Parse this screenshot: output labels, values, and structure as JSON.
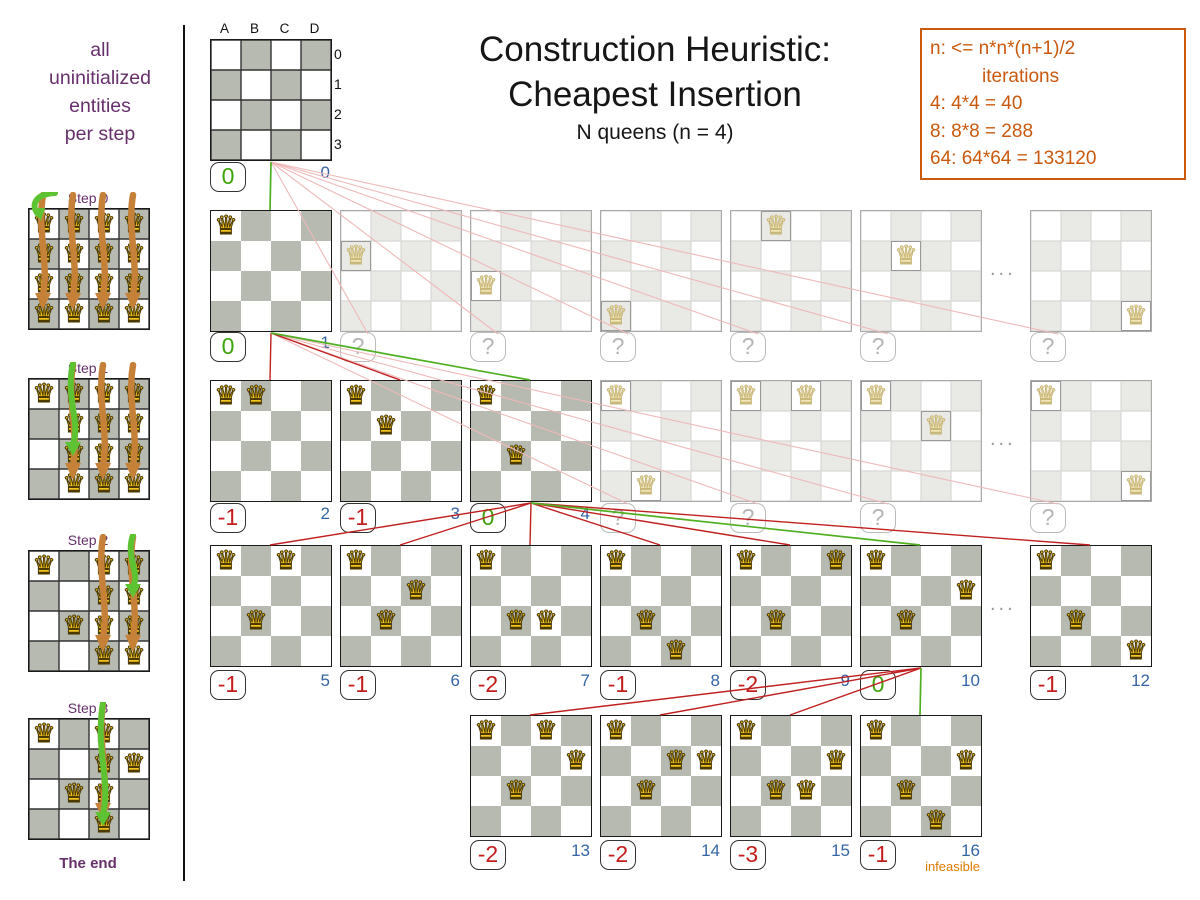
{
  "colors": {
    "purple": "#66306b",
    "orange": "#c9590f",
    "score_green": "#3fa30c",
    "score_red": "#c21e1e",
    "iteration_blue": "#3465a4",
    "line_green": "#4faf21",
    "line_red": "#c02020",
    "line_pruned": "#efb9b9",
    "board_gray": "#b7bab0",
    "queen_gold": "#f2c41d",
    "infeasible_orange": "#e07a00",
    "arrow_orange": "#c58138",
    "arrow_green": "#5ec332"
  },
  "sidebar": {
    "intro_lines": [
      "all",
      "uninitialized",
      "entities",
      "per step"
    ],
    "end_label": "The end",
    "steps": [
      {
        "label": "Step 0",
        "fixed": [],
        "candidate_columns": [
          "A",
          "B",
          "C",
          "D"
        ],
        "chosen": "A0"
      },
      {
        "label": "Step 1",
        "fixed": [
          "A0"
        ],
        "candidate_columns": [
          "B",
          "C",
          "D"
        ],
        "chosen": "B2"
      },
      {
        "label": "Step 2",
        "fixed": [
          "A0",
          "B2"
        ],
        "candidate_columns": [
          "C",
          "D"
        ],
        "chosen": "D1"
      },
      {
        "label": "Step 3",
        "fixed": [
          "A0",
          "B2",
          "D1"
        ],
        "candidate_columns": [
          "C"
        ],
        "chosen": "C3"
      }
    ]
  },
  "header": {
    "title_line1": "Construction Heuristic:",
    "title_line2": "Cheapest Insertion",
    "subtitle": "N queens (n = 4)"
  },
  "info_box": {
    "lines": [
      "n: <= n*n*(n+1)/2",
      "iterations",
      "4: 4*4 = 40",
      "8: 8*8 = 288",
      "64: 64*64 = 133120"
    ]
  },
  "root_labels": {
    "columns": [
      "A",
      "B",
      "C",
      "D"
    ],
    "rows": [
      "0",
      "1",
      "2",
      "3"
    ]
  },
  "tree": {
    "ellipsis": "...",
    "rows": [
      {
        "boards": [
          {
            "slot": 0,
            "queens": [],
            "score": "0",
            "iteration": "0"
          }
        ]
      },
      {
        "parent_slot": 0,
        "ellipsis": true,
        "boards": [
          {
            "slot": 0,
            "queens": [
              "A0"
            ],
            "score": "0",
            "iteration": "1",
            "link": "chosen"
          },
          {
            "slot": 1,
            "queens": [
              "A1"
            ],
            "score": "?",
            "link": "pruned"
          },
          {
            "slot": 2,
            "queens": [
              "A2"
            ],
            "score": "?",
            "link": "pruned"
          },
          {
            "slot": 3,
            "queens": [
              "A3"
            ],
            "score": "?",
            "link": "pruned"
          },
          {
            "slot": 4,
            "queens": [
              "B0"
            ],
            "score": "?",
            "link": "pruned"
          },
          {
            "slot": 5,
            "queens": [
              "B1"
            ],
            "score": "?",
            "link": "pruned"
          },
          {
            "slot": 7,
            "queens": [
              "D3"
            ],
            "score": "?",
            "link": "pruned"
          }
        ]
      },
      {
        "parent_slot": 0,
        "ellipsis": true,
        "boards": [
          {
            "slot": 0,
            "queens": [
              "A0",
              "B0"
            ],
            "score": "-1",
            "iteration": "2",
            "link": "evaluated"
          },
          {
            "slot": 1,
            "queens": [
              "A0",
              "B1"
            ],
            "score": "-1",
            "iteration": "3",
            "link": "evaluated"
          },
          {
            "slot": 2,
            "queens": [
              "A0",
              "B2"
            ],
            "score": "0",
            "iteration": "4",
            "link": "chosen"
          },
          {
            "slot": 3,
            "queens": [
              "A0",
              "B3"
            ],
            "score": "?",
            "link": "pruned"
          },
          {
            "slot": 4,
            "queens": [
              "A0",
              "C0"
            ],
            "score": "?",
            "link": "pruned"
          },
          {
            "slot": 5,
            "queens": [
              "A0",
              "C1"
            ],
            "score": "?",
            "link": "pruned"
          },
          {
            "slot": 7,
            "queens": [
              "A0",
              "D3"
            ],
            "score": "?",
            "link": "pruned"
          }
        ]
      },
      {
        "parent_slot": 2,
        "ellipsis": true,
        "boards": [
          {
            "slot": 0,
            "queens": [
              "A0",
              "B2",
              "C0"
            ],
            "score": "-1",
            "iteration": "5",
            "link": "evaluated"
          },
          {
            "slot": 1,
            "queens": [
              "A0",
              "B2",
              "C1"
            ],
            "score": "-1",
            "iteration": "6",
            "link": "evaluated"
          },
          {
            "slot": 2,
            "queens": [
              "A0",
              "B2",
              "C2"
            ],
            "score": "-2",
            "iteration": "7",
            "link": "evaluated"
          },
          {
            "slot": 3,
            "queens": [
              "A0",
              "B2",
              "C3"
            ],
            "score": "-1",
            "iteration": "8",
            "link": "evaluated"
          },
          {
            "slot": 4,
            "queens": [
              "A0",
              "B2",
              "D0"
            ],
            "score": "-2",
            "iteration": "9",
            "link": "evaluated"
          },
          {
            "slot": 5,
            "queens": [
              "A0",
              "B2",
              "D1"
            ],
            "score": "0",
            "iteration": "10",
            "link": "chosen"
          },
          {
            "slot": 7,
            "queens": [
              "A0",
              "B2",
              "D3"
            ],
            "score": "-1",
            "iteration": "12",
            "link": "evaluated"
          }
        ]
      },
      {
        "parent_slot": 5,
        "boards": [
          {
            "slot": 2,
            "queens": [
              "A0",
              "B2",
              "D1",
              "C0"
            ],
            "score": "-2",
            "iteration": "13",
            "link": "evaluated"
          },
          {
            "slot": 3,
            "queens": [
              "A0",
              "B2",
              "D1",
              "C1"
            ],
            "score": "-2",
            "iteration": "14",
            "link": "evaluated"
          },
          {
            "slot": 4,
            "queens": [
              "A0",
              "B2",
              "D1",
              "C2"
            ],
            "score": "-3",
            "iteration": "15",
            "link": "evaluated"
          },
          {
            "slot": 5,
            "queens": [
              "A0",
              "B2",
              "D1",
              "C3"
            ],
            "score": "-1",
            "iteration": "16",
            "link": "chosen",
            "note": "infeasible"
          }
        ]
      }
    ]
  }
}
